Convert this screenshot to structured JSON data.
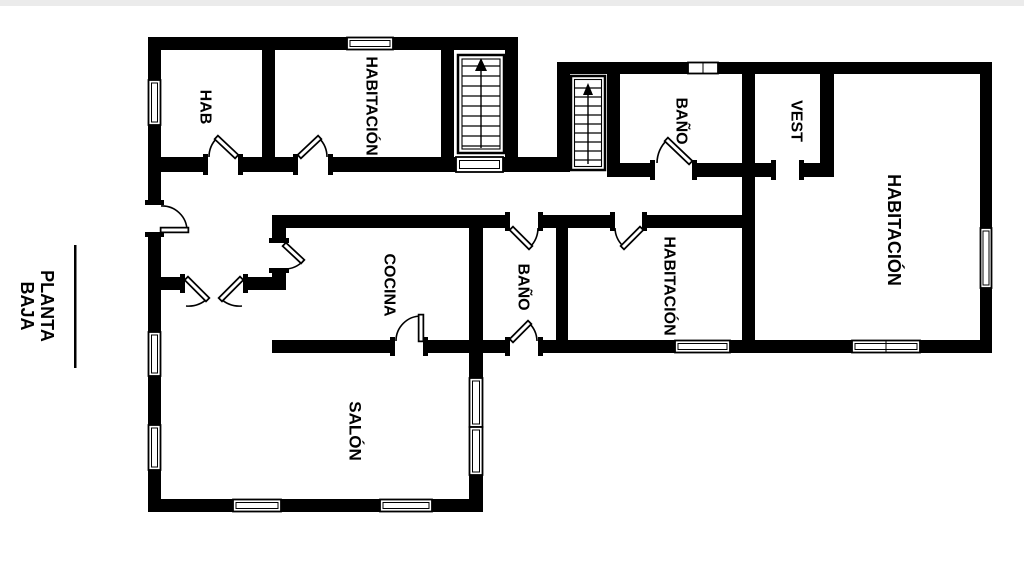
{
  "title": {
    "line1": "PLANTA",
    "line2": "BAJA"
  },
  "rooms": [
    {
      "id": "hab",
      "label": "HAB"
    },
    {
      "id": "habitacion-top",
      "label": "HABITACIÓN"
    },
    {
      "id": "bano-top",
      "label": "BAÑO"
    },
    {
      "id": "vest",
      "label": "VEST"
    },
    {
      "id": "habitacion-right",
      "label": "HABITACIÓN"
    },
    {
      "id": "cocina",
      "label": "COCINA"
    },
    {
      "id": "bano-mid",
      "label": "BAÑO"
    },
    {
      "id": "habitacion-mid",
      "label": "HABITACIÓN"
    },
    {
      "id": "salon",
      "label": "SALÓN"
    }
  ],
  "icons": {
    "staircase_up_arrow": "stairs-with-up-arrow"
  },
  "colors": {
    "wall": "#000000",
    "background": "#ffffff",
    "text": "#000000"
  }
}
